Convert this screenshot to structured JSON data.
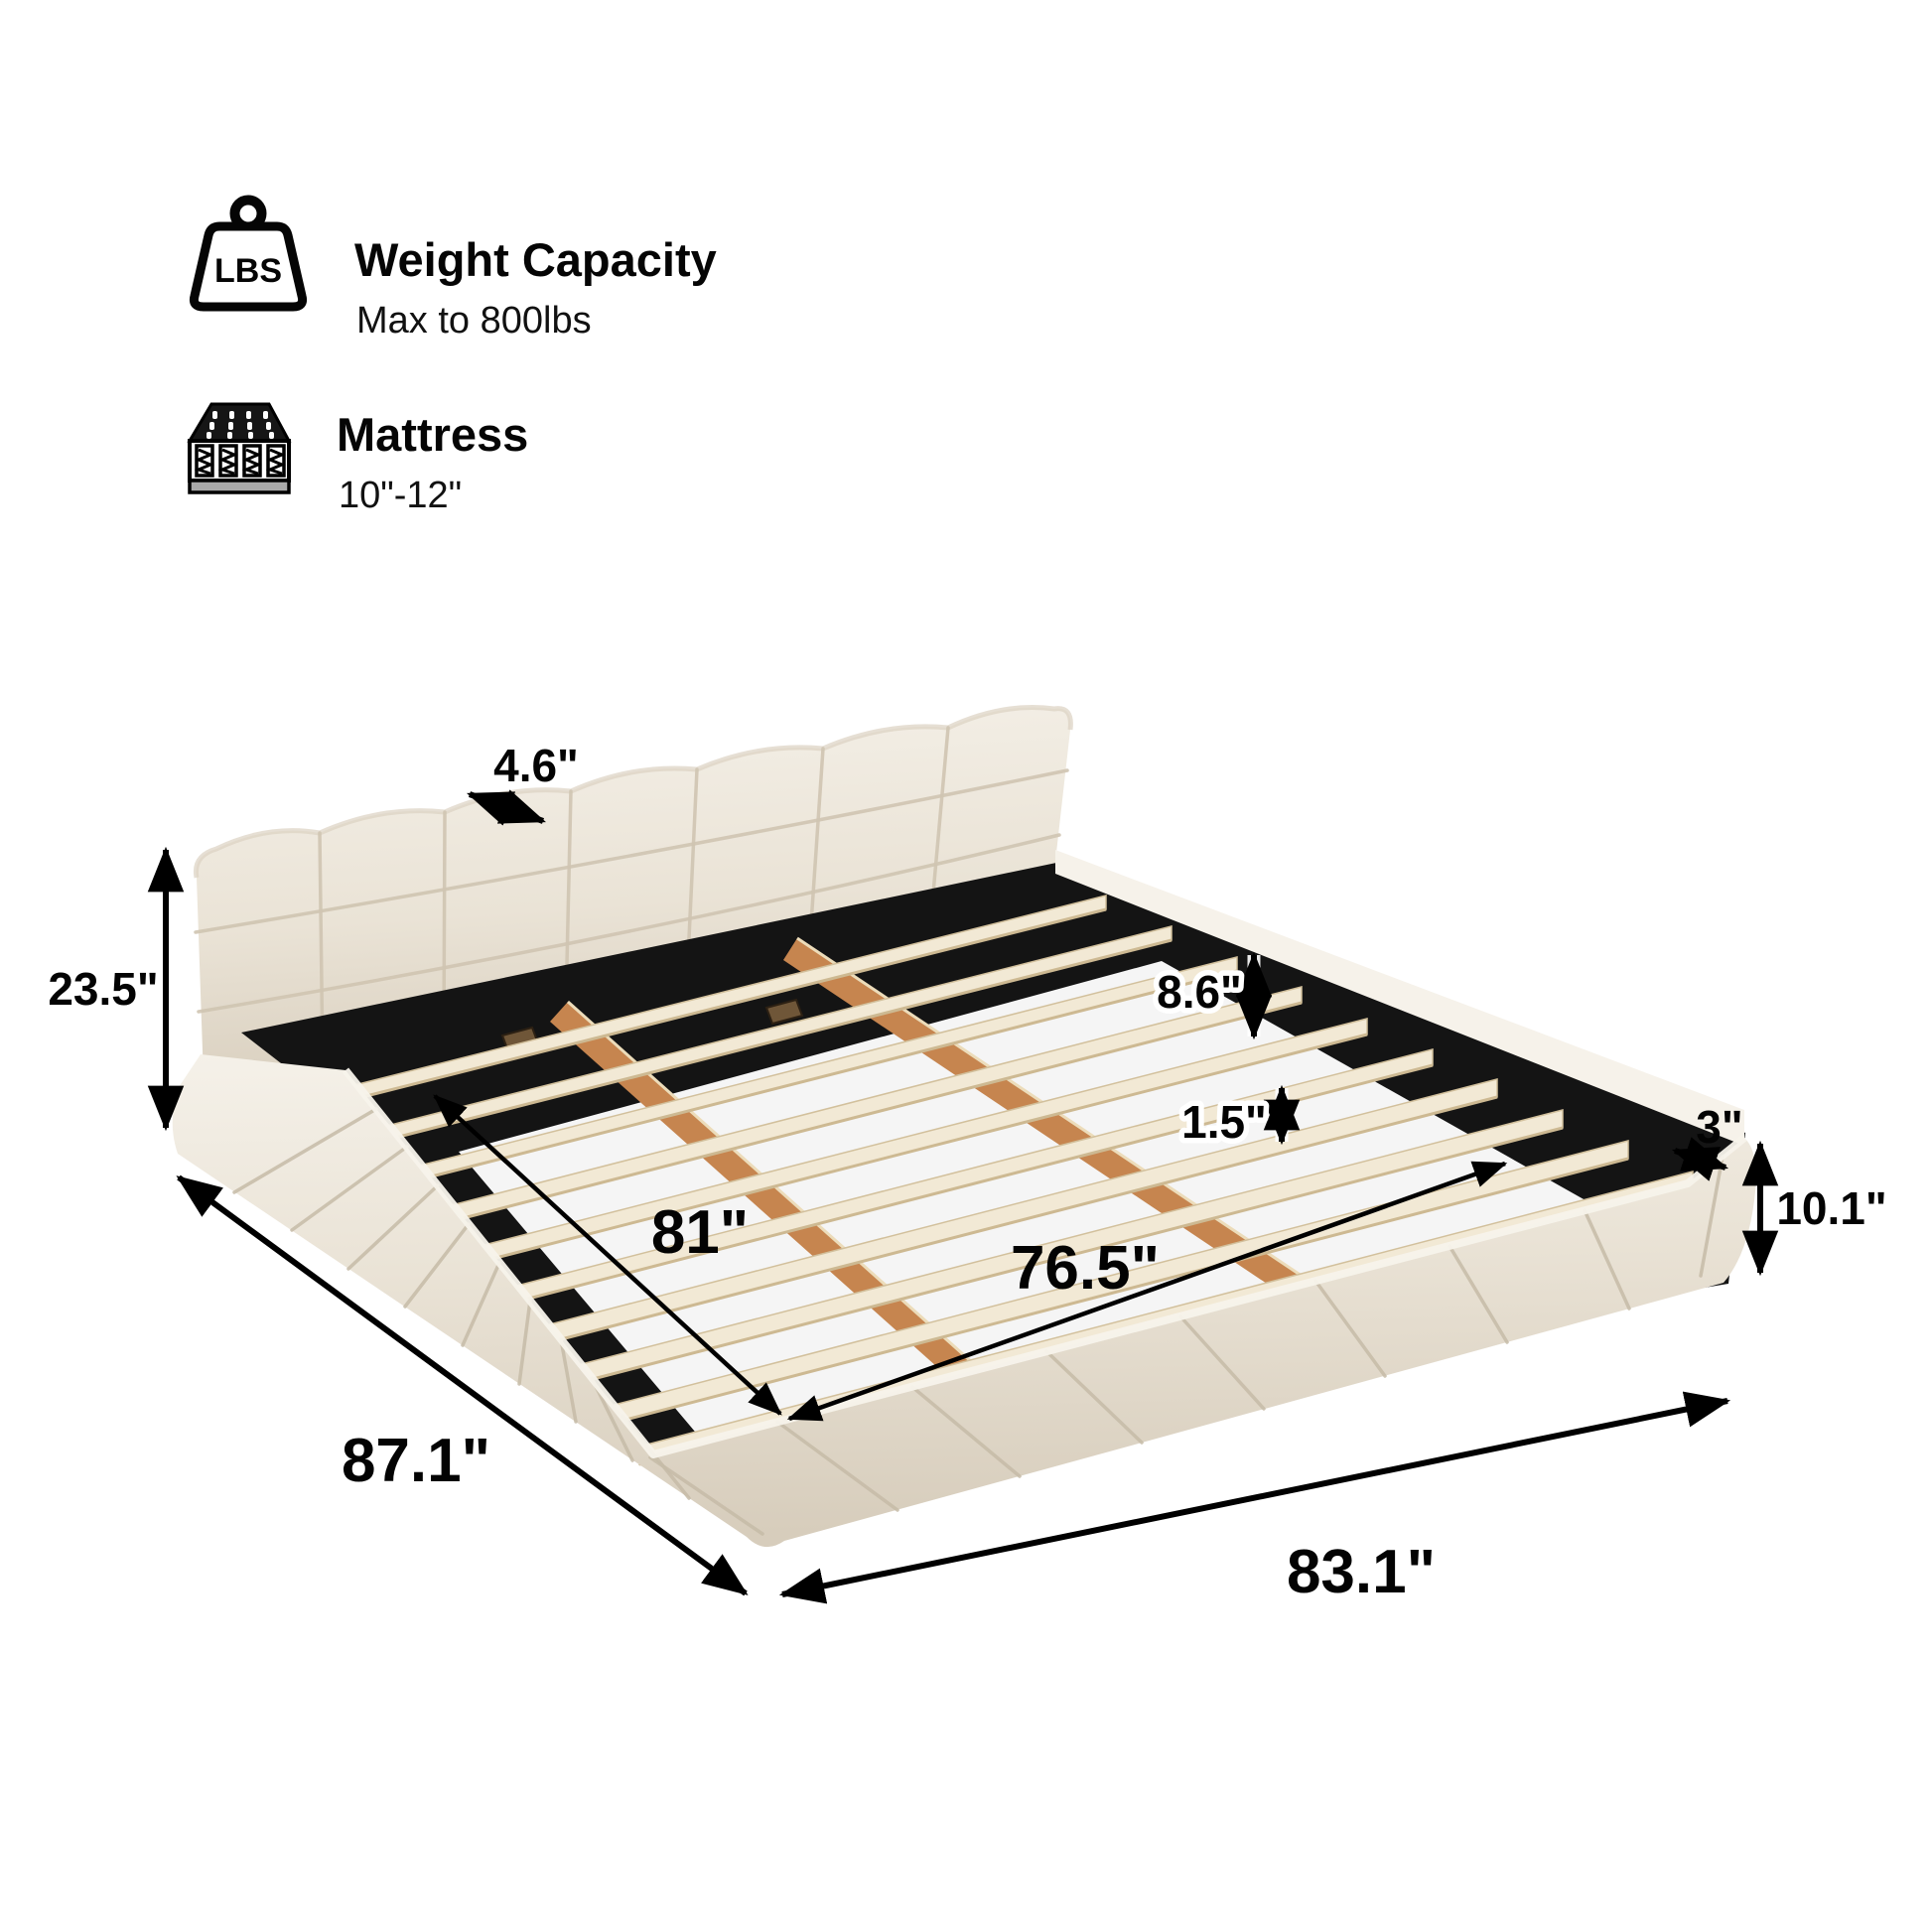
{
  "specs": {
    "weight": {
      "icon": "weight-lbs-icon",
      "icon_label": "LBS",
      "title": "Weight Capacity",
      "subtitle": "Max to 800lbs"
    },
    "mattress": {
      "icon": "mattress-icon",
      "title": "Mattress",
      "subtitle": "10\"-12\""
    }
  },
  "dimensions": {
    "headboard_thickness": "4.6\"",
    "headboard_height": "23.5\"",
    "frame_inner_height": "8.6\"",
    "slat_thickness": "1.5\"",
    "rail_top_width": "3\"",
    "base_height": "10.1\"",
    "slat_platform_length": "81\"",
    "slat_platform_width": "76.5\"",
    "overall_length": "87.1\"",
    "overall_width": "83.1\""
  },
  "colors": {
    "fabric": "#eae3d6",
    "fabric_light": "#f5f1e9",
    "fabric_shadow": "#d7cdbc",
    "interior": "#141414",
    "slat": "#f2e9d5",
    "wood": "#c6854f",
    "piping": "#f6f2ea",
    "arrow": "#000000"
  }
}
